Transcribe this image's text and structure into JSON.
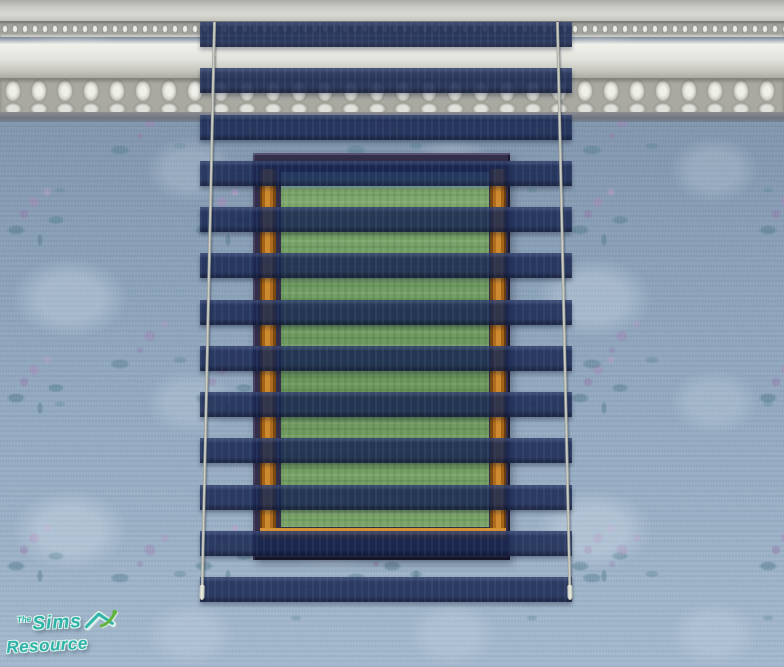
{
  "watermark": {
    "line1_prefix": "The",
    "line1_text": "Sims",
    "line2_text": "Resource",
    "house_icon": "tsr-house-icon",
    "logo_color": "#2fb3a8",
    "swoosh_color": "#63b23c"
  },
  "scene": {
    "blind_slat_count": 13,
    "cord_count": 2
  },
  "palette": {
    "wall_base": "#8ca2ba",
    "flower_purple": "#a383b8",
    "leaf_teal": "#4f7f95",
    "molding_light": "#f0f0ea",
    "molding_dark": "#84848a",
    "slat_navy": "rgba(23,38,80,0.85)",
    "frame_dark": "#332f4a",
    "wood_orange": "#b06c1e",
    "sky_teal": "#7fb0b4",
    "grass_green": "#6f9c62",
    "cord_silver": "#cdd0c6",
    "logo_teal": "#2fb3a8"
  }
}
